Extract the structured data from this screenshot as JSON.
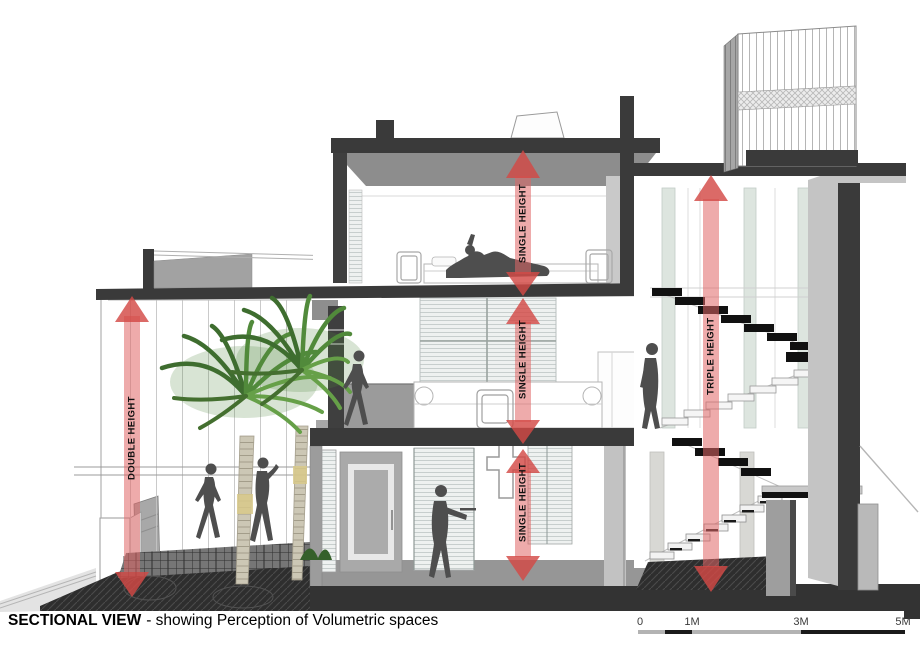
{
  "title": {
    "heading": "SECTIONAL VIEW",
    "description": "- showing Perception of Volumetric spaces"
  },
  "annotations": {
    "arrows": [
      {
        "id": "double-height",
        "label": "DOUBLE HEIGHT"
      },
      {
        "id": "single-height-upper",
        "label": "SINGLE HEIGHT"
      },
      {
        "id": "single-height-middle",
        "label": "SINGLE HEIGHT"
      },
      {
        "id": "single-height-lower",
        "label": "SINGLE HEIGHT"
      },
      {
        "id": "triple-height",
        "label": "TRIPLE HEIGHT"
      }
    ],
    "arrow_shaft_color": "#e06666",
    "arrow_head_color": "#d34946",
    "label_color": "#111111"
  },
  "scale_bar": {
    "labels": [
      "0",
      "1M",
      "3M",
      "5M"
    ],
    "segment_colors": [
      "#b3b3b3",
      "#1a1a1a",
      "#b3b3b3",
      "#1a1a1a"
    ]
  },
  "drawing": {
    "kind": "architectural-cross-section",
    "structure_color": "#3a3a3a",
    "features": [
      "palm trees",
      "human figures",
      "floating switchback staircase",
      "louvered roof pavilion",
      "bedroom",
      "living space",
      "cross wall niche",
      "entry gate and ramp",
      "hatched ground"
    ]
  }
}
